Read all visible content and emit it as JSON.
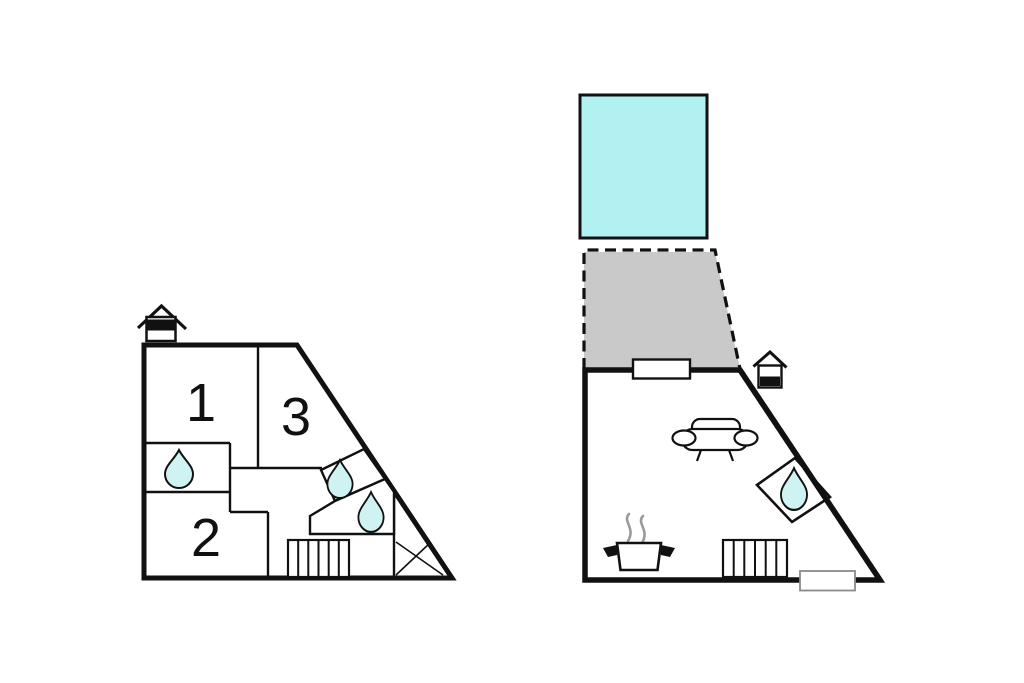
{
  "canvas": {
    "width": 1024,
    "height": 683,
    "background": "#ffffff"
  },
  "colors": {
    "wall": "#111111",
    "pool_fill": "#b2f1f2",
    "terrace_fill": "#c9c9c9",
    "water_drop_fill": "#cff3f3",
    "steam": "#9a9a9a"
  },
  "upper_floor": {
    "rooms": [
      {
        "label": "1"
      },
      {
        "label": "2"
      },
      {
        "label": "3"
      }
    ],
    "icons": [
      "house-level-indicator",
      "water-drop",
      "water-drop",
      "water-drop",
      "stairs",
      "cross-marker"
    ]
  },
  "ground_floor": {
    "icons": [
      "house-level-indicator",
      "pool",
      "terrace",
      "sofa",
      "shower-water-drop",
      "cooking-pot-with-steam",
      "stairs",
      "door",
      "door"
    ]
  }
}
